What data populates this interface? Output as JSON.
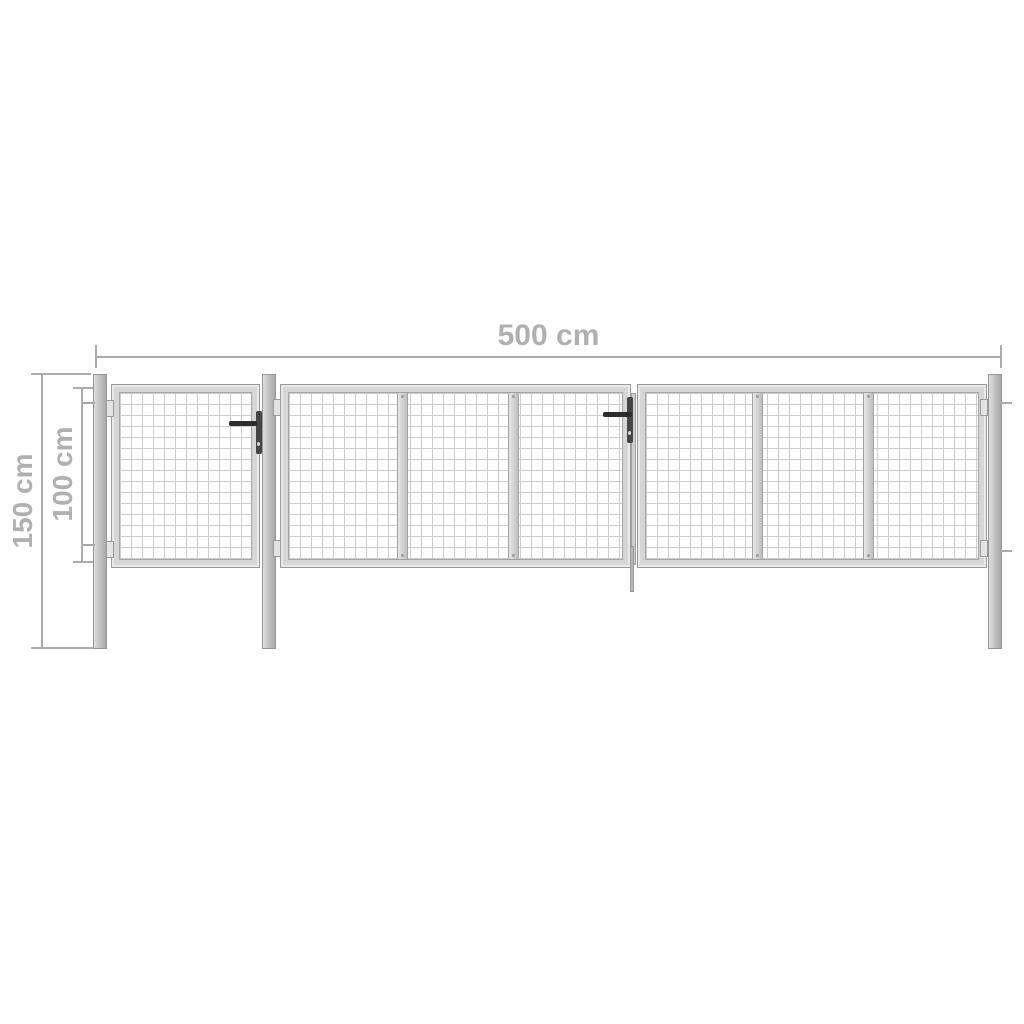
{
  "diagram": {
    "dimensions": {
      "width": {
        "label": "500 cm"
      },
      "total_height": {
        "label": "150 cm"
      },
      "gate_height": {
        "label": "100 cm"
      }
    },
    "colors": {
      "background": "#ffffff",
      "dimension_gray": "#acacac",
      "label_gray": "#b0b0b0",
      "frame_fill": "#d6d6d6",
      "frame_border": "#9a9a9a",
      "mesh_line": "#cdcdcd",
      "post_gradient_dark": "#a9a9a9",
      "handle_black": "#2b2b2b"
    },
    "components": {
      "posts_count": 3,
      "gate_leaves": [
        "pedestrian-gate",
        "double-gate-left-leaf",
        "double-gate-right-leaf"
      ],
      "handles_count": 2,
      "mesh_panels_per_large_leaf": 3
    }
  }
}
